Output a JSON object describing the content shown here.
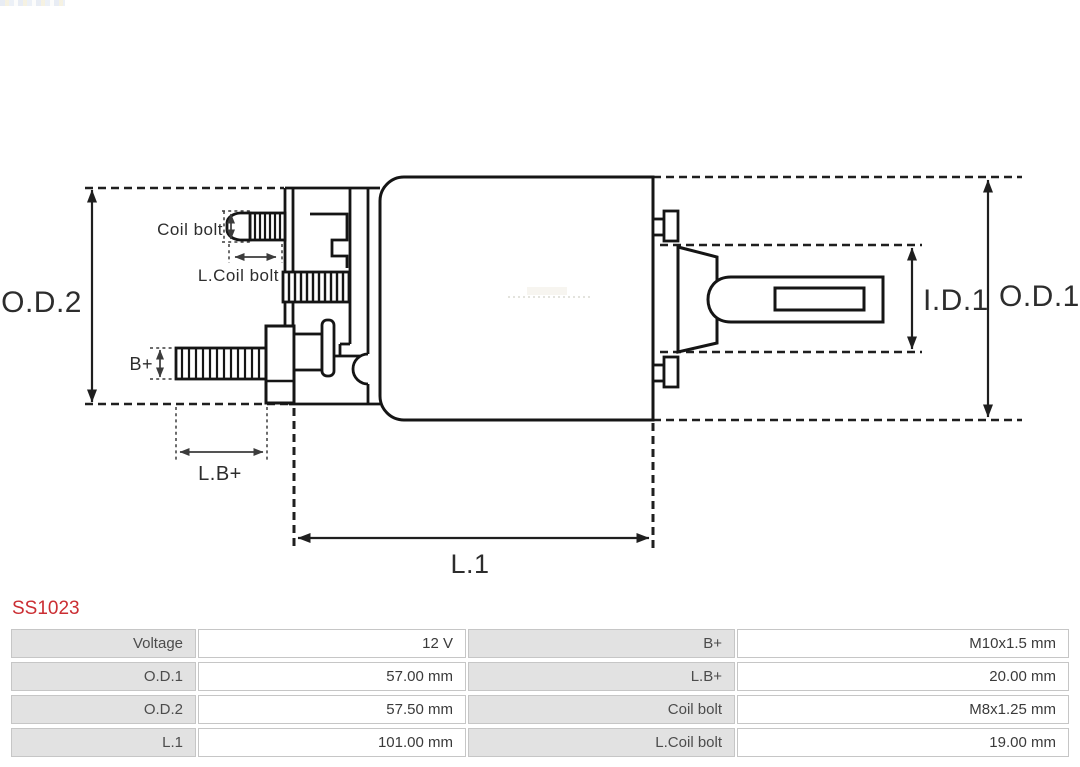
{
  "part_code": "SS1023",
  "colors": {
    "part_code_red": "#cb2e33",
    "table_label_bg": "#e2e2e2",
    "table_border": "#c6c6c6",
    "diagram_ink": "#1f1f1f"
  },
  "diagram": {
    "labels": {
      "od2": "O.D.2",
      "od1": "O.D.1",
      "id1": "I.D.1",
      "l1": "L.1",
      "lb_plus": "L.B+",
      "b_plus": "B+",
      "coil_bolt": "Coil bolt",
      "l_coil_bolt": "L.Coil bolt"
    }
  },
  "specs": {
    "rows": [
      {
        "label_left": "Voltage",
        "value_left": "12 V",
        "label_right": "B+",
        "value_right": "M10x1.5 mm"
      },
      {
        "label_left": "O.D.1",
        "value_left": "57.00 mm",
        "label_right": "L.B+",
        "value_right": "20.00 mm"
      },
      {
        "label_left": "O.D.2",
        "value_left": "57.50 mm",
        "label_right": "Coil bolt",
        "value_right": "M8x1.25 mm"
      },
      {
        "label_left": "L.1",
        "value_left": "101.00 mm",
        "label_right": "L.Coil bolt",
        "value_right": "19.00 mm"
      }
    ]
  }
}
